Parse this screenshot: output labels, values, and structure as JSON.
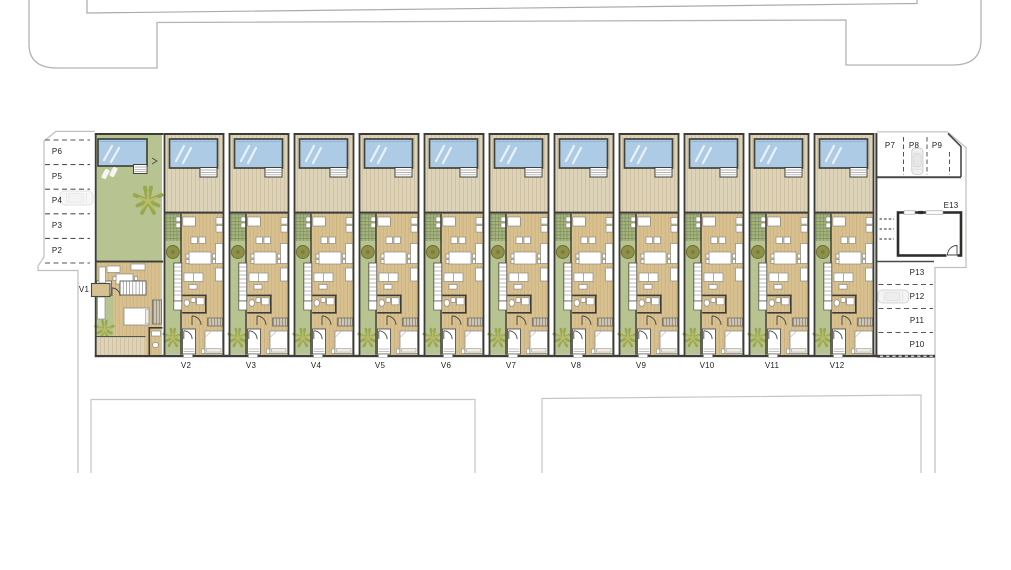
{
  "plan": {
    "title_note": "",
    "units": [
      {
        "id": "v1",
        "label": "V1"
      },
      {
        "id": "v2",
        "label": "V2"
      },
      {
        "id": "v3",
        "label": "V3"
      },
      {
        "id": "v4",
        "label": "V4"
      },
      {
        "id": "v5",
        "label": "V5"
      },
      {
        "id": "v6",
        "label": "V6"
      },
      {
        "id": "v7",
        "label": "V7"
      },
      {
        "id": "v8",
        "label": "V8"
      },
      {
        "id": "v9",
        "label": "V9"
      },
      {
        "id": "v10",
        "label": "V10"
      },
      {
        "id": "v11",
        "label": "V11"
      },
      {
        "id": "v12",
        "label": "V12"
      }
    ],
    "parking_left": {
      "labels": [
        "P6",
        "P5",
        "P4",
        "P3",
        "P2"
      ]
    },
    "parking_top_right": {
      "labels": [
        "P7",
        "P8",
        "P9"
      ]
    },
    "parking_right": {
      "labels": [
        "P13",
        "P12",
        "P11",
        "P10"
      ]
    },
    "storeroom": {
      "label": "E13"
    },
    "icons": {
      "car_icon_spaces": [
        "P4",
        "P8",
        "P12"
      ],
      "tree_icons": "round-tree and palm-tree glyphs in unit gardens",
      "pool_icons": "rectangular pool with step box per unit"
    },
    "palette": {
      "pool_water": "#aecbe6",
      "deck_wood": "#ddd3b9",
      "lawn_green": "#b7c491",
      "interior_wood": "#d8c190",
      "pergola_green": "#a7b681",
      "wall_dark": "#3c3c38",
      "boundary_gray": "#bfbfbf",
      "road_gray": "#b3b3b3",
      "label_text": "#222222"
    }
  }
}
